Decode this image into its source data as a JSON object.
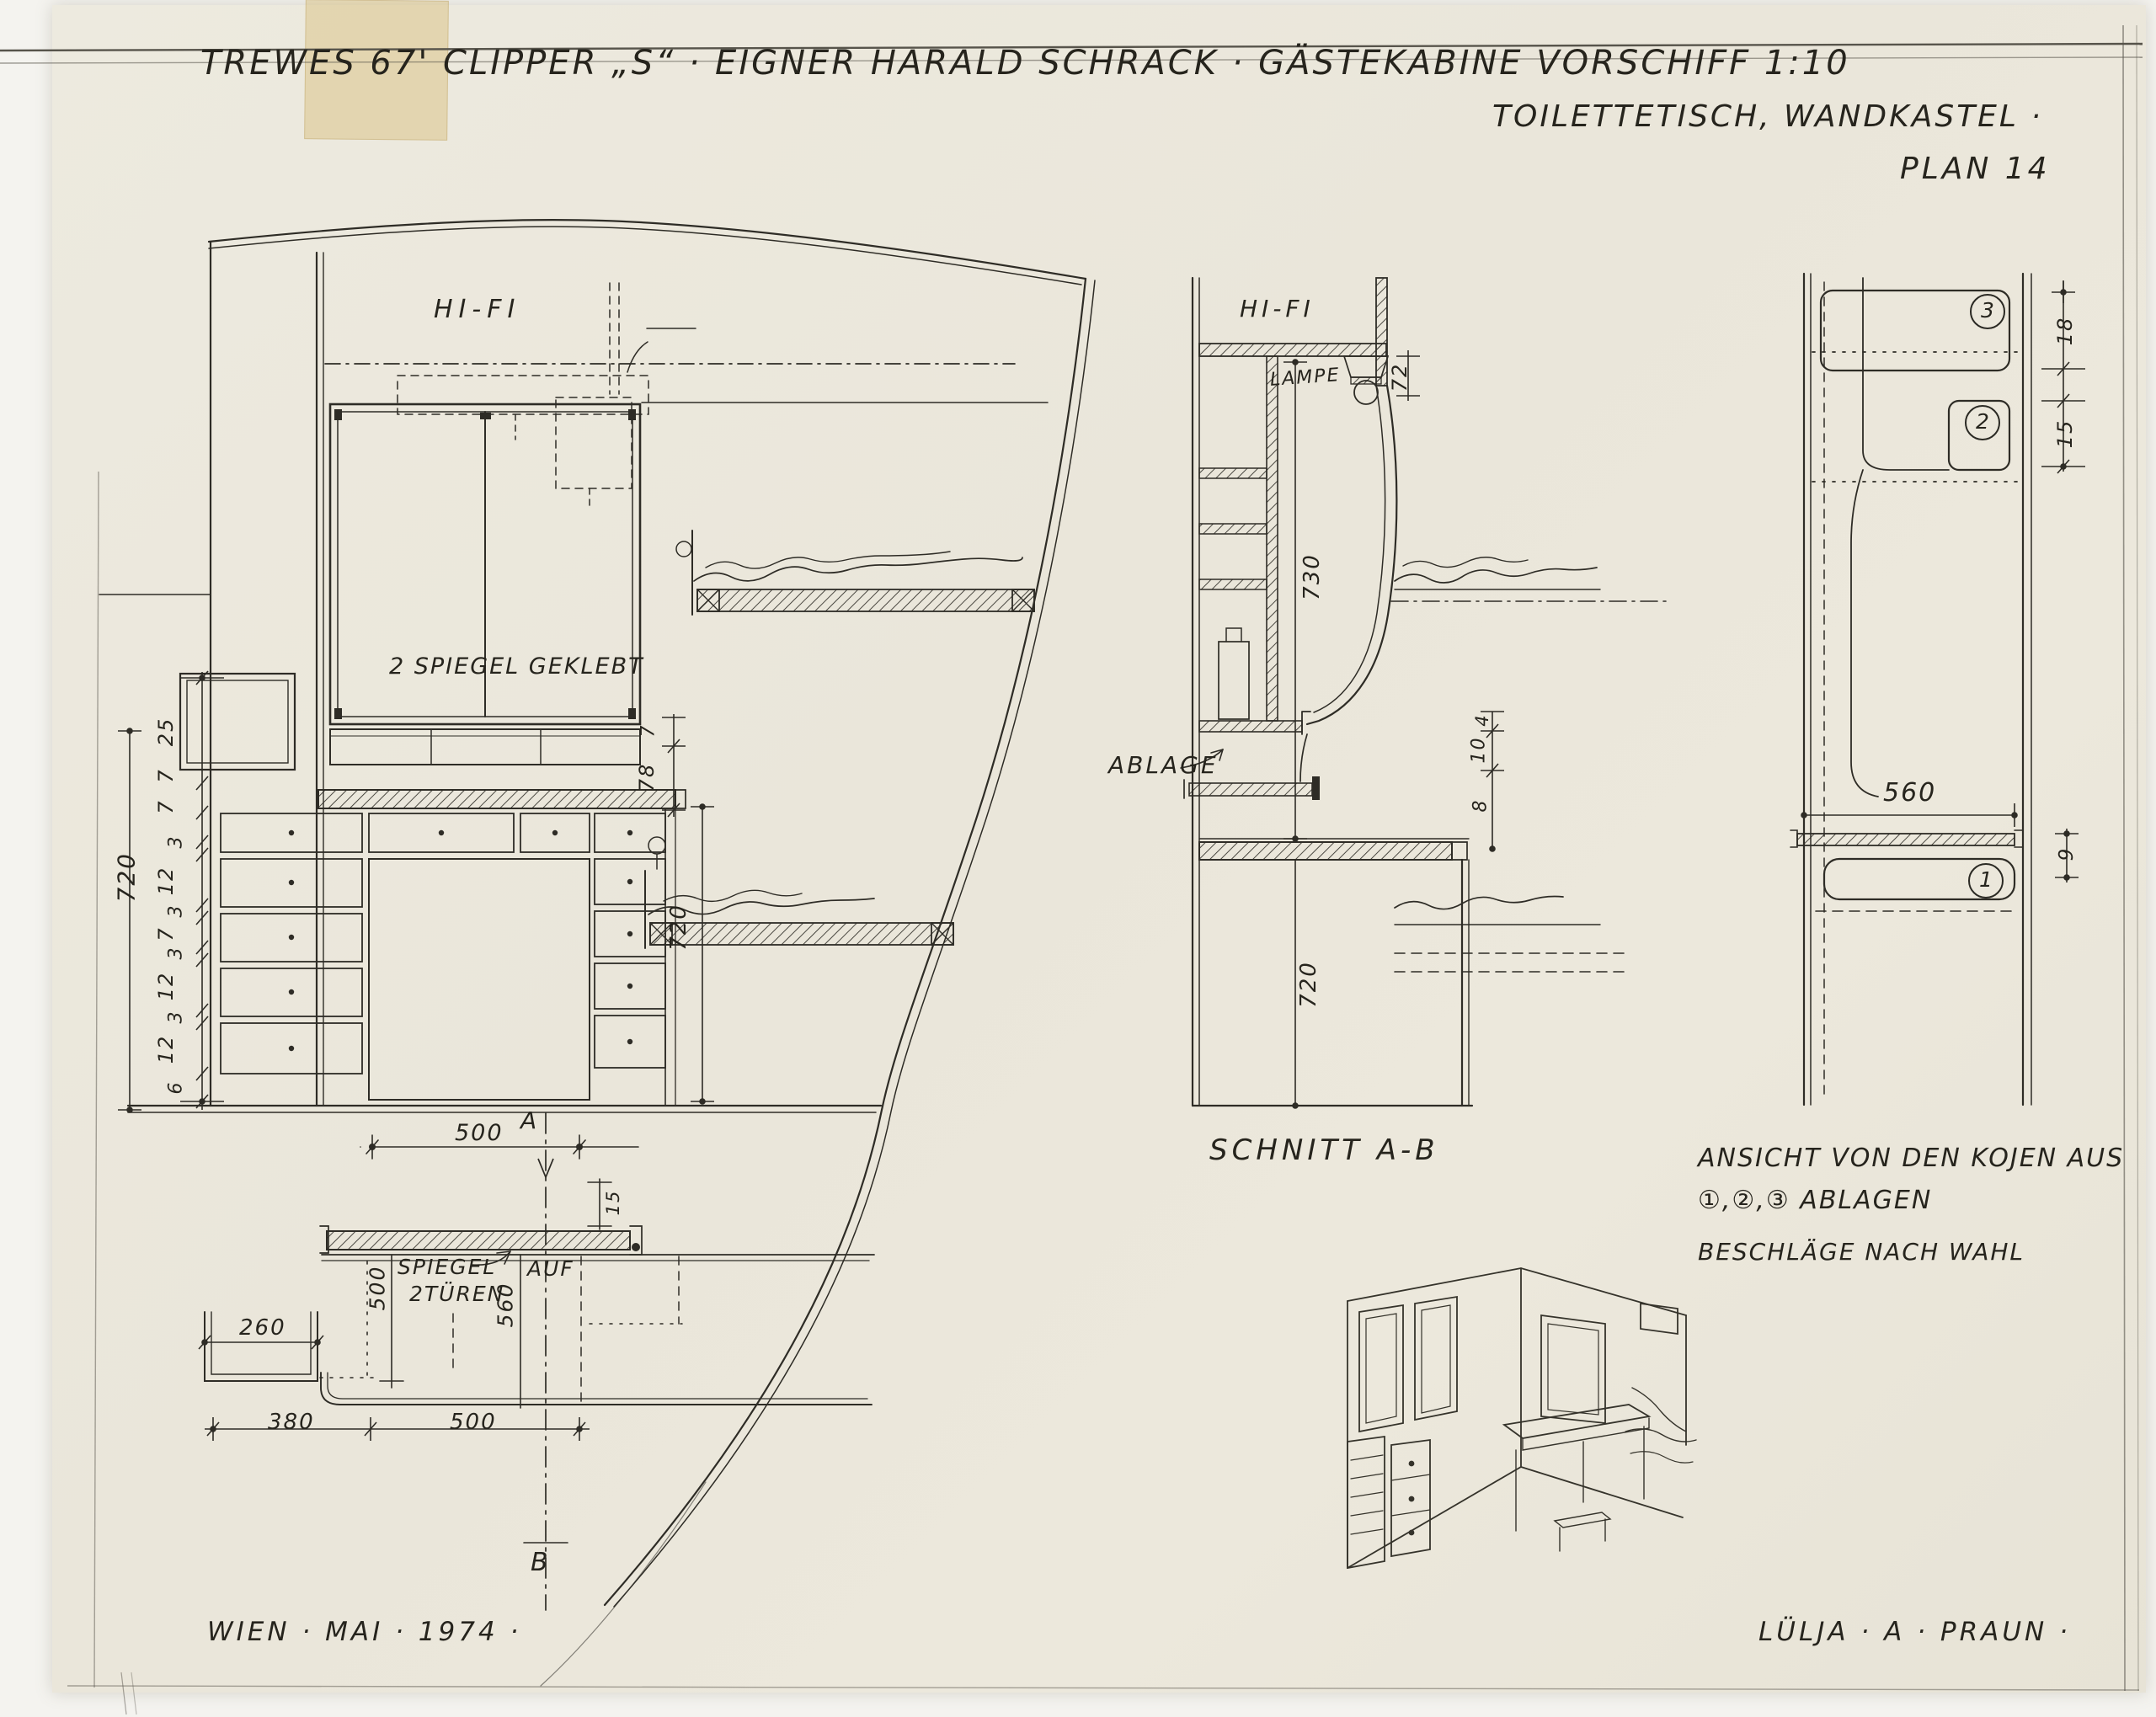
{
  "title": {
    "line1": "TREWES 67' CLIPPER „S“ · EIGNER HARALD SCHRACK · GÄSTEKABINE VORSCHIFF 1:10",
    "line2": "TOILETTETISCH, WANDKASTEL ·",
    "plan": "PLAN 14"
  },
  "front_view": {
    "hifi": "HI-FI",
    "mirror_note": "2 SPIEGEL GEKLEBT",
    "dim_total": "720",
    "dim_chain": [
      "25",
      "7",
      "7",
      "3",
      "12",
      "3",
      "7",
      "3",
      "12",
      "3",
      "12",
      "6"
    ],
    "dim_7": "7",
    "dim_78": "78",
    "dim_unit_height": "720"
  },
  "section_view": {
    "caption": "SCHNITT A-B",
    "hifi": "HI-FI",
    "lampe": "LAMPE",
    "ablage": "ABLAGE",
    "dim_72": "72",
    "dim_730": "730",
    "dim_720": "720",
    "dim_4": "4",
    "dim_10": "10",
    "dim_8": "8"
  },
  "berth_view": {
    "caption_line1": "ANSICHT VON DEN KOJEN AUS",
    "caption_line2": "①,②,③ ABLAGEN",
    "note": "BESCHLÄGE NACH WAHL",
    "badge_1": "1",
    "badge_2": "2",
    "badge_3": "3",
    "dim_560": "560",
    "dim_18": "18",
    "dim_15": "15",
    "dim_9": "9"
  },
  "plan_top_view": {
    "marker_a": "A",
    "marker_b": "B",
    "dim_500_top": "500",
    "dim_15": "15",
    "spiegel_line1": "SPIEGEL",
    "spiegel_line2": "2TÜREN",
    "auf": "AUF",
    "dim_500_left": "500",
    "dim_560_mid": "560",
    "dim_260": "260",
    "dim_380": "380",
    "dim_500_bottom": "500"
  },
  "footer": {
    "place_date": "WIEN · MAI · 1974 ·",
    "author": "LÜLJA · A · PRAUN ·"
  },
  "colors": {
    "ink": "#2e2c26",
    "paper": "#eae6da",
    "tape": "#d6ba70"
  }
}
